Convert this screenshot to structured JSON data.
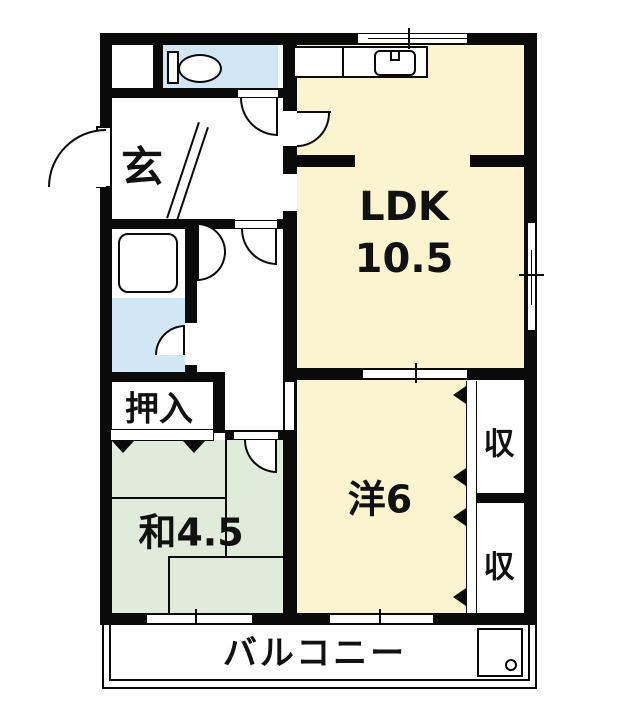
{
  "floorplan": {
    "rooms": {
      "entrance": {
        "label": "玄"
      },
      "ldk": {
        "line1": "LDK",
        "line2": "10.5"
      },
      "closet": {
        "label": "押入"
      },
      "japanese_room": {
        "label": "和4.5"
      },
      "western_room": {
        "label": "洋6"
      },
      "storage_top": {
        "label": "収"
      },
      "storage_bottom": {
        "label": "収"
      },
      "balcony": {
        "label": "バルコニー"
      }
    },
    "colors": {
      "room_yellow": "#FAF5CF",
      "room_blue": "#D2E7F4",
      "room_green": "#E0EBDC",
      "wall": "#0a0a0a",
      "bg": "#ffffff"
    }
  }
}
